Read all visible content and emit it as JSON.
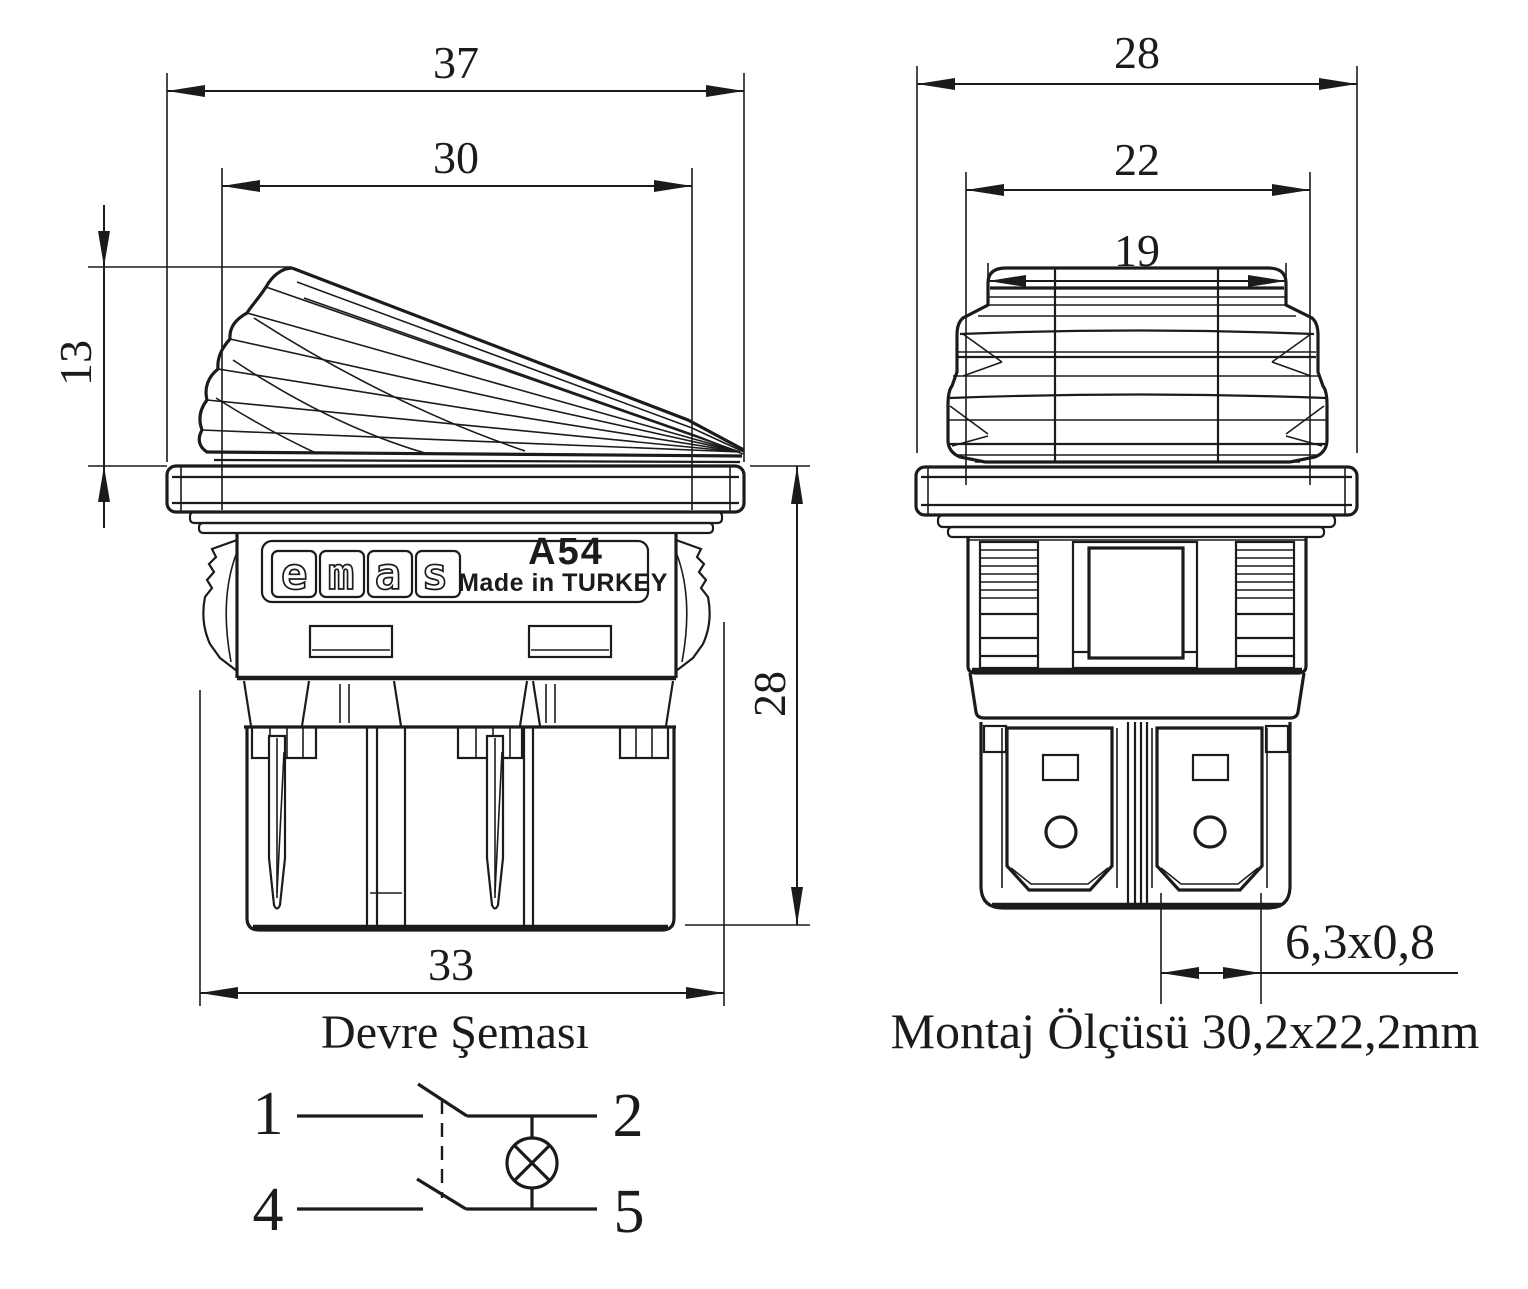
{
  "colors": {
    "line": "#1b1b1b",
    "background": "#ffffff"
  },
  "left_view": {
    "dim_flange_width": "37",
    "dim_rocker_width": "30",
    "dim_rocker_height": "13",
    "dim_body_height": "28",
    "dim_body_width": "33",
    "brand_logo": "emas",
    "model_code": "A54",
    "origin_text": "Made in TURKEY"
  },
  "right_view": {
    "dim_flange_width": "28",
    "dim_cap_width": "22",
    "dim_top_width": "19",
    "dim_terminal_size": "6,3x0,8",
    "mounting_note": "Montaj Ölçüsü 30,2x22,2mm"
  },
  "schematic": {
    "title": "Devre Şeması",
    "terminal_1": "1",
    "terminal_2": "2",
    "terminal_4": "4",
    "terminal_5": "5"
  }
}
